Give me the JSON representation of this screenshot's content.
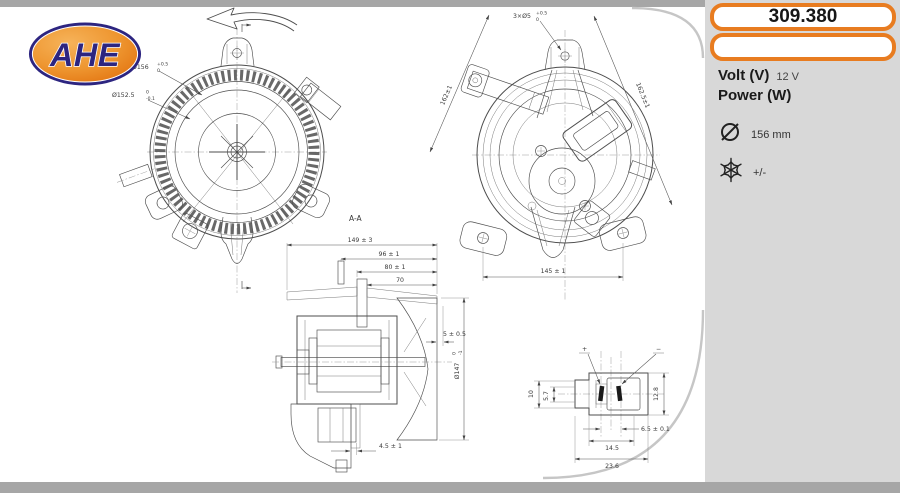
{
  "colors": {
    "accent_orange": "#e87c20",
    "sidebar_gray": "#d8d8d8",
    "bar_gray": "#a6a6a6",
    "line_gray": "#4d4d4d",
    "logo_navy": "#2d2580"
  },
  "logo": {
    "text": "AHE"
  },
  "sidebar": {
    "part_number": "309.380",
    "secondary_box": "",
    "volt_label": "Volt (V)",
    "volt_value": "12 V",
    "power_label": "Power (W)",
    "power_value": "",
    "diameter_value": "156 mm",
    "climate_value": "+/-"
  },
  "dims": {
    "front_outer_base": "Ø156",
    "front_outer_hi": "+0.5",
    "front_outer_lo": "0",
    "front_inner_base": "Ø152.5",
    "front_inner_hi": "0",
    "front_inner_lo": "-0.1",
    "rear_holes_base": "3×Ø5",
    "rear_holes_hi": "+0.5",
    "rear_holes_lo": "0",
    "rear_left": "162±1",
    "rear_right": "162.5±1",
    "rear_bottom": "145 ± 1",
    "section_label": "A-A",
    "sec_149": "149 ± 3",
    "sec_96": "96 ± 1",
    "sec_80": "80 ± 1",
    "sec_70": "70",
    "sec_5": "5 ± 0.5",
    "sec_fan_base": "Ø147",
    "sec_fan_hi": "0",
    "sec_fan_lo": "-1",
    "sec_45": "4.5 ± 1",
    "con_10": "10",
    "con_57": "5.7",
    "con_128": "12.8",
    "con_65": "6.5 ± 0.1",
    "con_145": "14.5",
    "con_236": "23.6",
    "con_plus": "+",
    "con_minus": "−"
  }
}
